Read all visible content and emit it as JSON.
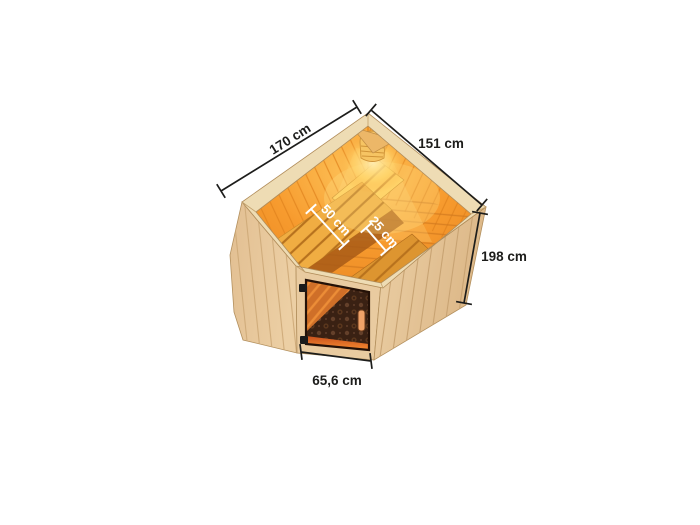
{
  "figure": {
    "type": "product-dimension-diagram",
    "subject": "corner sauna, top front view, open roof showing benches, corner lamp and bronze glass door",
    "background_color": "#ffffff"
  },
  "measurements": {
    "left_wall_width": "170 cm",
    "right_wall_width": "151 cm",
    "height": "198 cm",
    "main_bench_depth": "50 cm",
    "lower_bench_depth": "25 cm",
    "door_width": "65,6 cm"
  },
  "colors": {
    "dimension_lines": "#1d1d1b",
    "dimension_labels_dark": "#1d1d1b",
    "dimension_labels_light": "#ffffff",
    "wood_exterior": "#e7c79c",
    "wood_rim": "#eedcb4",
    "interior_glow_orange": "#f79b2e",
    "bench_gold": "#f0ad42",
    "door_glass_bronze": "#3a2113",
    "lamp_light": "#ffe9ad"
  }
}
